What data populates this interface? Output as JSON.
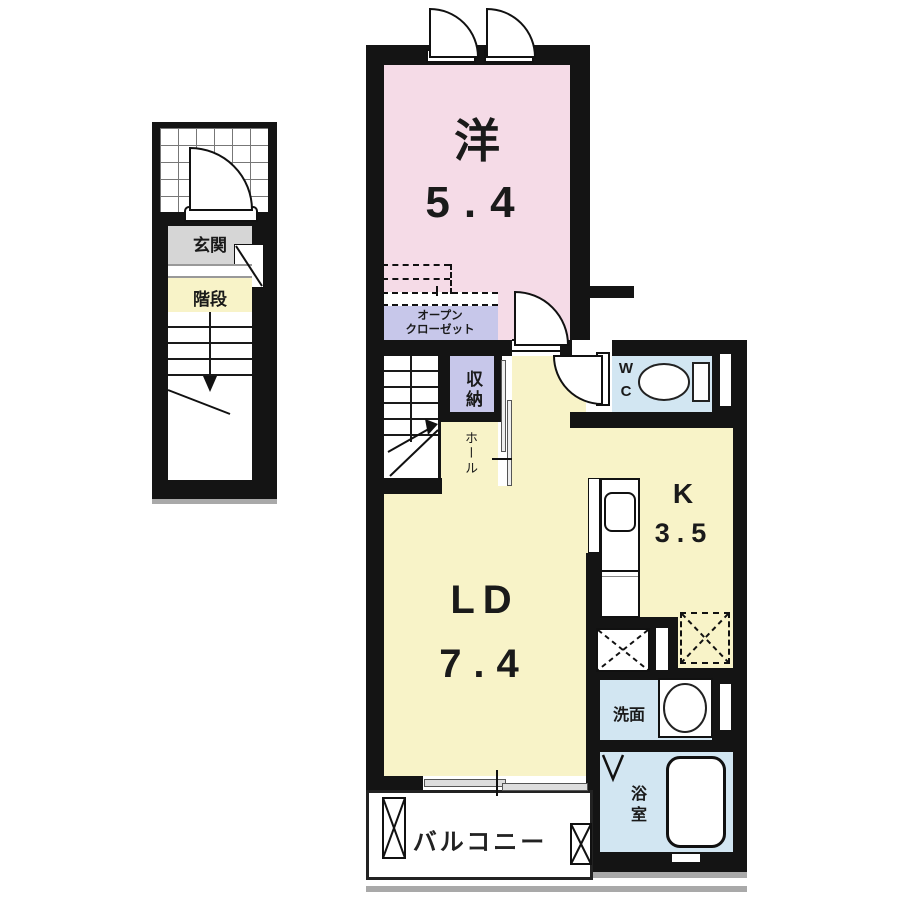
{
  "plan": {
    "type": "apartment floor plan",
    "rooms": {
      "western": {
        "name": "洋",
        "area": "5.4"
      },
      "living_dining": {
        "name": "LD",
        "area": "7.4"
      },
      "kitchen": {
        "name": "K",
        "area": "3.5"
      },
      "entrance": {
        "name": "玄関"
      },
      "stairs": {
        "name": "階段"
      },
      "open_closet": {
        "line1": "オープン",
        "line2": "クローゼット"
      },
      "storage": {
        "name": "収納"
      },
      "hall": {
        "name": "ホール"
      },
      "toilet": {
        "name": "WC"
      },
      "washroom": {
        "name": "洗面"
      },
      "bathroom": {
        "name": "浴室"
      },
      "balcony": {
        "name": "バルコニー"
      }
    },
    "colors": {
      "wall": "#141414",
      "western_room_pink": "#f5dbe7",
      "ldk_yellow": "#f8f3c8",
      "closet_lavender": "#c7c7ea",
      "wet_area_blue": "#d2e6f2",
      "entrance_gray": "#d6d6d6",
      "shadow_gray": "#a9a9a9"
    }
  }
}
